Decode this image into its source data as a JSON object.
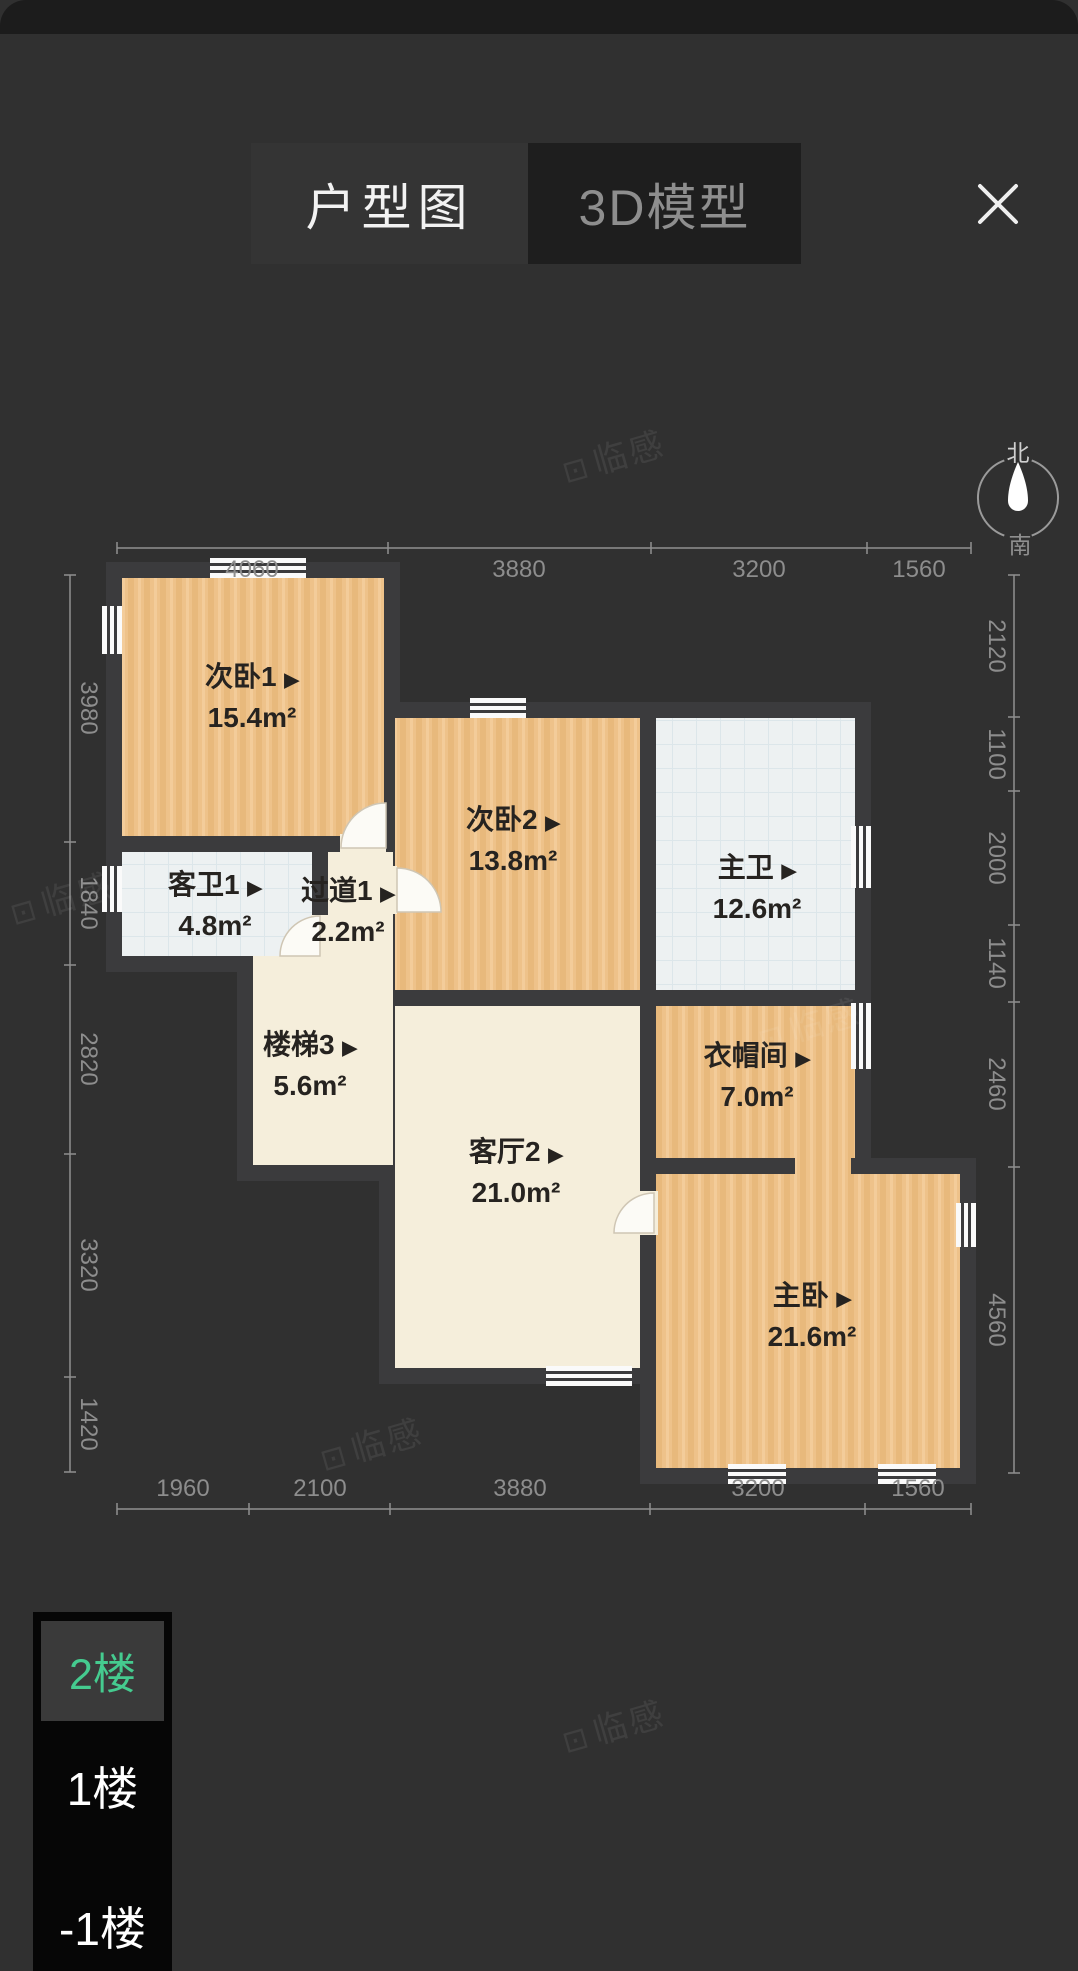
{
  "header": {
    "tabs": [
      {
        "label": "户型图",
        "active": true
      },
      {
        "label": "3D模型",
        "active": false
      }
    ],
    "close_label": "✕"
  },
  "compass": {
    "north": "北",
    "south": "南"
  },
  "plan": {
    "arrow": "▶",
    "rooms": [
      {
        "id": "secondary-bedroom-1",
        "name": "次卧1",
        "area": "15.4m²"
      },
      {
        "id": "guest-bath-1",
        "name": "客卫1",
        "area": "4.8m²"
      },
      {
        "id": "hallway-1",
        "name": "过道1",
        "area": "2.2m²"
      },
      {
        "id": "stairs-3",
        "name": "楼梯3",
        "area": "5.6m²"
      },
      {
        "id": "secondary-bedroom-2",
        "name": "次卧2",
        "area": "13.8m²"
      },
      {
        "id": "master-bath",
        "name": "主卫",
        "area": "12.6m²"
      },
      {
        "id": "living-room-2",
        "name": "客厅2",
        "area": "21.0m²"
      },
      {
        "id": "cloakroom",
        "name": "衣帽间",
        "area": "7.0m²"
      },
      {
        "id": "master-bedroom",
        "name": "主卧",
        "area": "21.6m²"
      }
    ],
    "dims_top": [
      "4060",
      "3880",
      "3200",
      "1560"
    ],
    "dims_bottom": [
      "1960",
      "2100",
      "3880",
      "3200",
      "1560"
    ],
    "dims_left": [
      "3980",
      "1840",
      "2820",
      "3320",
      "1420"
    ],
    "dims_right": [
      "2120",
      "1100",
      "2000",
      "1140",
      "2460",
      "4560"
    ]
  },
  "floor_selector": {
    "floors": [
      {
        "label": "2楼",
        "active": true
      },
      {
        "label": "1楼",
        "active": false
      },
      {
        "label": "-1楼",
        "active": false
      }
    ]
  },
  "watermark": {
    "logo": "⊡",
    "text": "临感"
  },
  "colors": {
    "background": "#303030",
    "wall": "#3b3b3d",
    "wood": "#eec28a",
    "tile": "#edf1f2",
    "cream": "#f5eedb",
    "accent_green": "#45cb8f"
  }
}
